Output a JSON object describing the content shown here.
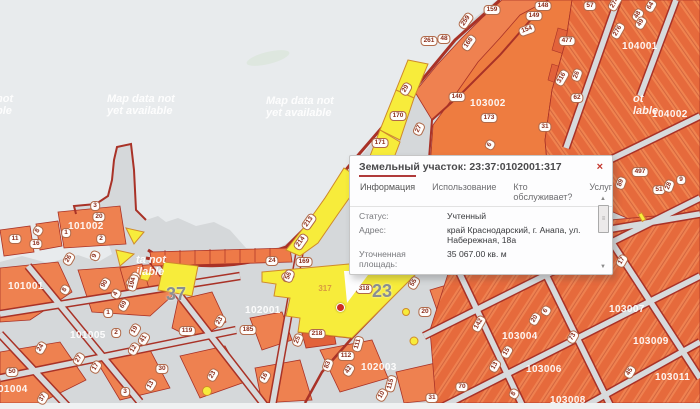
{
  "popup": {
    "title": "Земельный участок: 23:37:0102001:317",
    "close_label": "×",
    "tabs": [
      {
        "label": "Информация",
        "active": true
      },
      {
        "label": "Использование",
        "active": false
      },
      {
        "label": "Кто обслуживает?",
        "active": false
      },
      {
        "label": "Услуги",
        "active": false
      }
    ],
    "rows": [
      {
        "label": "Статус:",
        "value": "Учтенный"
      },
      {
        "label": "Адрес:",
        "value": "край Краснодарский, г. Анапа, ул. Набережная, 18а"
      },
      {
        "label": "Уточненная площадь:",
        "value": "35 067.00 кв. м"
      },
      {
        "label": "Кадастровая стоимость:",
        "value": "25 248.24 руб."
      },
      {
        "label": "Форма собственности:",
        "value": "Нет данных"
      }
    ],
    "scrollbar": {
      "up": "▲",
      "down": "▼",
      "grip": "≡"
    }
  },
  "map": {
    "colors": {
      "water": "#e8ebed",
      "street": "#d7dadc",
      "parcel": "#ef8150",
      "block": "#ee7c40",
      "road": "#a93227",
      "highlight": "#f7ec3b",
      "pin": "#cf2b20",
      "accent_tab": "#b03a3a"
    },
    "selected_parcel": "317",
    "watermarks": [
      {
        "l1": "Map data not",
        "l2": "yet available",
        "x": 107,
        "y": 94
      },
      {
        "l1": "Map data not",
        "l2": "yet available",
        "x": 266,
        "y": 96
      },
      {
        "l1": "not",
        "l2": "ble",
        "x": -4,
        "y": 94
      },
      {
        "l1": "ot",
        "l2": "lable",
        "x": 633,
        "y": 94
      },
      {
        "l1": "ta not",
        "l2": "ilable",
        "x": 136,
        "y": 255
      }
    ],
    "quarter_labels": [
      {
        "t": "101002",
        "x": 68,
        "y": 221
      },
      {
        "t": "101001",
        "x": 8,
        "y": 281
      },
      {
        "t": "101005",
        "x": 70,
        "y": 330
      },
      {
        "t": "101004",
        "x": -8,
        "y": 384
      },
      {
        "t": "102001",
        "x": 245,
        "y": 305
      },
      {
        "t": "102003",
        "x": 361,
        "y": 362
      },
      {
        "t": "103002",
        "x": 470,
        "y": 98
      },
      {
        "t": "103004",
        "x": 502,
        "y": 331
      },
      {
        "t": "103006",
        "x": 526,
        "y": 364
      },
      {
        "t": "103007",
        "x": 609,
        "y": 304
      },
      {
        "t": "103008",
        "x": 550,
        "y": 395
      },
      {
        "t": "103009",
        "x": 633,
        "y": 336
      },
      {
        "t": "103011",
        "x": 655,
        "y": 372
      },
      {
        "t": "104001",
        "x": 622,
        "y": 41
      },
      {
        "t": "104002",
        "x": 652,
        "y": 109
      }
    ],
    "block_numbers": [
      {
        "t": "37",
        "x": 166,
        "y": 284
      },
      {
        "t": "23",
        "x": 372,
        "y": 281
      }
    ],
    "parcel_labels": [
      {
        "t": "159",
        "x": 492,
        "y": 10
      },
      {
        "t": "259",
        "x": 466,
        "y": 21,
        "r": -55
      },
      {
        "t": "261",
        "x": 429,
        "y": 41
      },
      {
        "t": "48",
        "x": 444,
        "y": 39
      },
      {
        "t": "168",
        "x": 469,
        "y": 43,
        "r": -55
      },
      {
        "t": "148",
        "x": 543,
        "y": 6
      },
      {
        "t": "149",
        "x": 534,
        "y": 16
      },
      {
        "t": "154",
        "x": 527,
        "y": 30,
        "r": -20
      },
      {
        "t": "57",
        "x": 590,
        "y": 6
      },
      {
        "t": "274",
        "x": 615,
        "y": 3,
        "r": -60
      },
      {
        "t": "48",
        "x": 638,
        "y": 15,
        "r": -60
      },
      {
        "t": "49",
        "x": 641,
        "y": 23,
        "r": -60
      },
      {
        "t": "64",
        "x": 651,
        "y": 6,
        "r": -60
      },
      {
        "t": "276",
        "x": 618,
        "y": 31,
        "r": -60
      },
      {
        "t": "477",
        "x": 567,
        "y": 41
      },
      {
        "t": "316",
        "x": 562,
        "y": 78,
        "r": -60
      },
      {
        "t": "26",
        "x": 577,
        "y": 75,
        "r": -70
      },
      {
        "t": "62",
        "x": 577,
        "y": 98
      },
      {
        "t": "140",
        "x": 457,
        "y": 97
      },
      {
        "t": "173",
        "x": 489,
        "y": 118
      },
      {
        "t": "31",
        "x": 545,
        "y": 127
      },
      {
        "t": "6",
        "x": 490,
        "y": 145,
        "r": -60
      },
      {
        "t": "29",
        "x": 406,
        "y": 89,
        "r": -60
      },
      {
        "t": "170",
        "x": 398,
        "y": 116
      },
      {
        "t": "27",
        "x": 419,
        "y": 129,
        "r": -65
      },
      {
        "t": "171",
        "x": 380,
        "y": 143
      },
      {
        "t": "213",
        "x": 309,
        "y": 222,
        "r": -55
      },
      {
        "t": "214",
        "x": 301,
        "y": 242,
        "r": -55
      },
      {
        "t": "169",
        "x": 304,
        "y": 262
      },
      {
        "t": "24",
        "x": 272,
        "y": 261
      },
      {
        "t": "10",
        "x": 288,
        "y": 276,
        "r": -30
      },
      {
        "t": "124",
        "x": 133,
        "y": 280,
        "r": -55
      },
      {
        "t": "89",
        "x": 621,
        "y": 183,
        "r": -70
      },
      {
        "t": "497",
        "x": 640,
        "y": 172
      },
      {
        "t": "51",
        "x": 659,
        "y": 190
      },
      {
        "t": "28",
        "x": 669,
        "y": 186,
        "r": -70
      },
      {
        "t": "9",
        "x": 681,
        "y": 180
      },
      {
        "t": "17",
        "x": 622,
        "y": 261,
        "r": -60
      },
      {
        "t": "3",
        "x": 95,
        "y": 206
      },
      {
        "t": "20",
        "x": 99,
        "y": 217
      },
      {
        "t": "1",
        "x": 66,
        "y": 233
      },
      {
        "t": "2",
        "x": 101,
        "y": 239
      },
      {
        "t": "11",
        "x": 15,
        "y": 239
      },
      {
        "t": "8",
        "x": 38,
        "y": 231,
        "r": -60
      },
      {
        "t": "16",
        "x": 36,
        "y": 244
      },
      {
        "t": "26",
        "x": 69,
        "y": 259,
        "r": -60
      },
      {
        "t": "9",
        "x": 95,
        "y": 256,
        "r": -70
      },
      {
        "t": "8",
        "x": 65,
        "y": 290,
        "r": -60
      },
      {
        "t": "90",
        "x": 105,
        "y": 284,
        "r": -60
      },
      {
        "t": "4",
        "x": 116,
        "y": 294,
        "r": -60
      },
      {
        "t": "194",
        "x": 133,
        "y": 283,
        "r": -75
      },
      {
        "t": "69",
        "x": 124,
        "y": 305,
        "r": -60
      },
      {
        "t": "1",
        "x": 108,
        "y": 313
      },
      {
        "t": "2",
        "x": 116,
        "y": 333
      },
      {
        "t": "19",
        "x": 135,
        "y": 330,
        "r": -60
      },
      {
        "t": "41",
        "x": 144,
        "y": 339,
        "r": -60
      },
      {
        "t": "12",
        "x": 134,
        "y": 349,
        "r": -60
      },
      {
        "t": "24",
        "x": 41,
        "y": 348,
        "r": -60
      },
      {
        "t": "27",
        "x": 79,
        "y": 359,
        "r": -60
      },
      {
        "t": "17",
        "x": 96,
        "y": 367,
        "r": -60
      },
      {
        "t": "50",
        "x": 12,
        "y": 372
      },
      {
        "t": "119",
        "x": 187,
        "y": 331
      },
      {
        "t": "23",
        "x": 220,
        "y": 321,
        "r": -60
      },
      {
        "t": "30",
        "x": 162,
        "y": 369
      },
      {
        "t": "13",
        "x": 151,
        "y": 385,
        "r": -60
      },
      {
        "t": "3",
        "x": 125,
        "y": 392
      },
      {
        "t": "37",
        "x": 43,
        "y": 398,
        "r": -60
      },
      {
        "t": "23",
        "x": 213,
        "y": 375,
        "r": -60
      },
      {
        "t": "185",
        "x": 248,
        "y": 330
      },
      {
        "t": "218",
        "x": 317,
        "y": 334
      },
      {
        "t": "25",
        "x": 298,
        "y": 340,
        "r": -70
      },
      {
        "t": "56",
        "x": 289,
        "y": 276,
        "r": -70
      },
      {
        "t": "16",
        "x": 265,
        "y": 377,
        "r": -60
      },
      {
        "t": "112",
        "x": 346,
        "y": 356
      },
      {
        "t": "111",
        "x": 358,
        "y": 344,
        "r": -75
      },
      {
        "t": "83",
        "x": 328,
        "y": 365,
        "r": -70
      },
      {
        "t": "42",
        "x": 349,
        "y": 370,
        "r": -60
      },
      {
        "t": "115",
        "x": 391,
        "y": 384,
        "r": -75
      },
      {
        "t": "10",
        "x": 382,
        "y": 395,
        "r": -60
      },
      {
        "t": "31",
        "x": 432,
        "y": 398
      },
      {
        "t": "70",
        "x": 462,
        "y": 387
      },
      {
        "t": "20",
        "x": 425,
        "y": 312
      },
      {
        "t": "55",
        "x": 414,
        "y": 283,
        "r": -60
      },
      {
        "t": "318",
        "x": 364,
        "y": 289
      },
      {
        "t": "317",
        "x": 325,
        "y": 289,
        "s": "plain"
      },
      {
        "t": "142",
        "x": 479,
        "y": 324,
        "r": -60
      },
      {
        "t": "20",
        "x": 535,
        "y": 319,
        "r": -60
      },
      {
        "t": "6",
        "x": 546,
        "y": 311,
        "r": -60
      },
      {
        "t": "15",
        "x": 507,
        "y": 352,
        "r": -60
      },
      {
        "t": "13",
        "x": 495,
        "y": 366,
        "r": -60
      },
      {
        "t": "8",
        "x": 514,
        "y": 394,
        "r": -60
      },
      {
        "t": "73",
        "x": 573,
        "y": 337,
        "r": -60
      },
      {
        "t": "45",
        "x": 630,
        "y": 372,
        "r": -60
      }
    ]
  }
}
